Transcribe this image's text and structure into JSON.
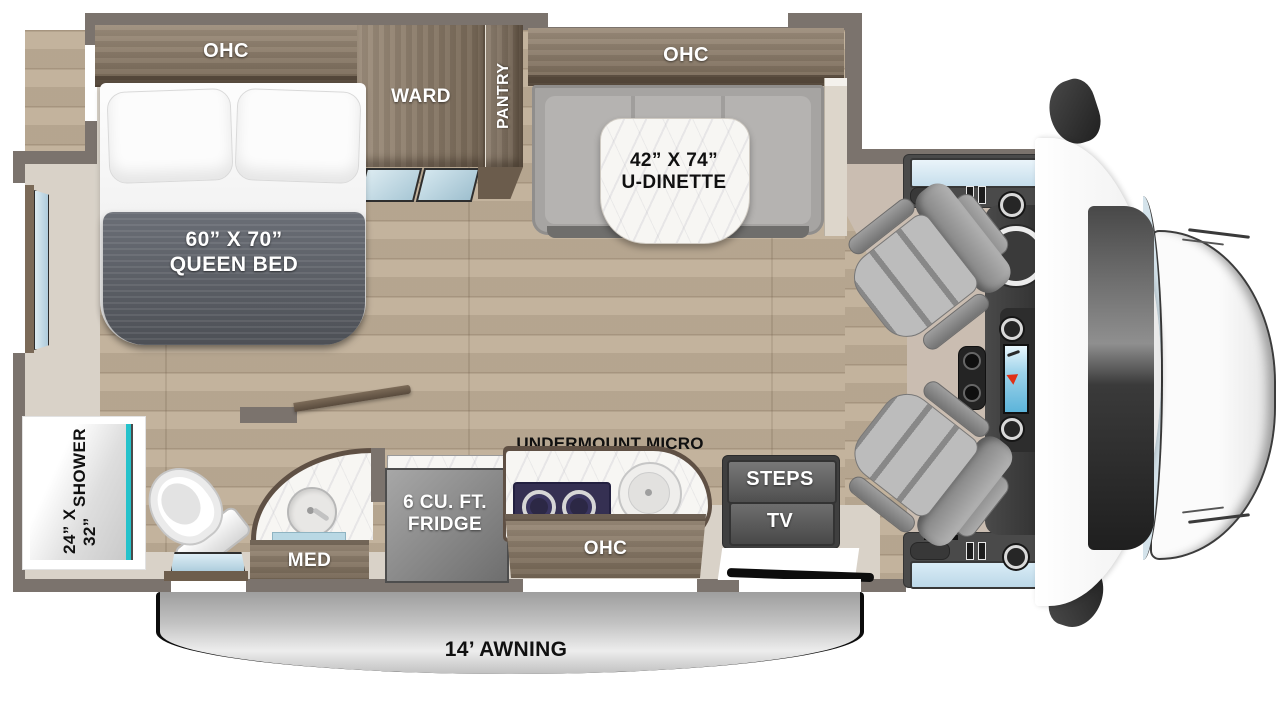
{
  "floorplan": {
    "bedroom": {
      "ohc": "OHC",
      "ward": "WARD",
      "pantry": "PANTRY",
      "bed_size": "60” X 70”",
      "bed_name": "QUEEN BED"
    },
    "dinette": {
      "ohc": "OHC",
      "size": "42” X 74”",
      "name": "U-DINETTE"
    },
    "bathroom": {
      "shower_size": "24” X 32”",
      "shower_name": "SHOWER",
      "med": "MED"
    },
    "kitchen": {
      "micro": "UNDERMOUNT MICRO",
      "fridge_line1": "6 CU. FT.",
      "fridge_line2": "FRIDGE",
      "ohc": "OHC"
    },
    "entry": {
      "steps": "STEPS",
      "tv": "TV"
    },
    "exterior": {
      "awning": "14’ AWNING"
    },
    "colors": {
      "wall": "#7b736d",
      "wood_floor": "#bfae97",
      "cabinet_wood": "#8d7b66",
      "cabinet_rim": "#5c5043",
      "window_glass": "#cfe3ee",
      "shower_accent_teal": "#25c2cb",
      "bed_blanket": "#585c63",
      "dinette_cushion": "#a6a4a2",
      "seat_gray": "#9e9e9e",
      "dash_dark": "#3b3b3b",
      "awning_gray": "#b5b5b5",
      "counter_marble": "#f7f6f3",
      "cab_floor": "#cabdb1"
    }
  }
}
